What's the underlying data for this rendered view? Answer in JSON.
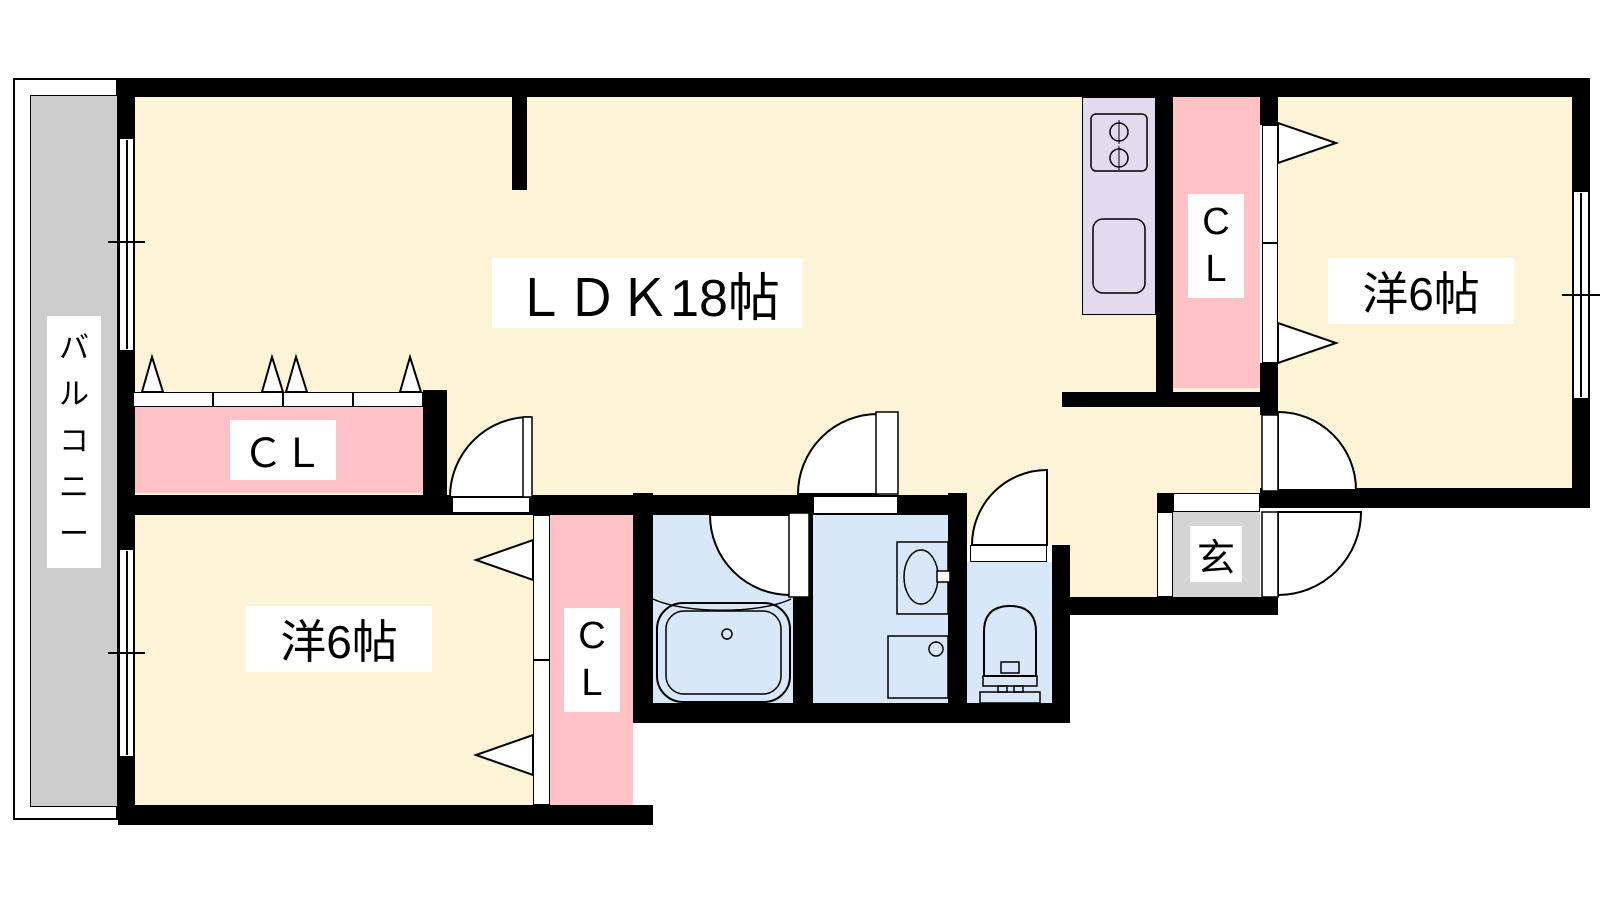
{
  "floorplan": {
    "labels": {
      "ldk": "ＬＤＫ18帖",
      "western_room_right": "洋6帖",
      "western_room_left": "洋6帖",
      "closet_top_left": "ＣＬ",
      "closet_right": "C\nL",
      "closet_bottom": "C\nL",
      "balcony": "バ\nル\nコ\nニ\nー",
      "entrance": "玄"
    },
    "colors": {
      "room": "#fdf3d6",
      "kitchen": "#e4daf0",
      "closet": "#ffc2c6",
      "bath": "#d9e8f8",
      "balcony": "#cdcdcd",
      "entrance": "#d4d4d4",
      "wall": "#000000",
      "paper": "#ffffff"
    }
  }
}
